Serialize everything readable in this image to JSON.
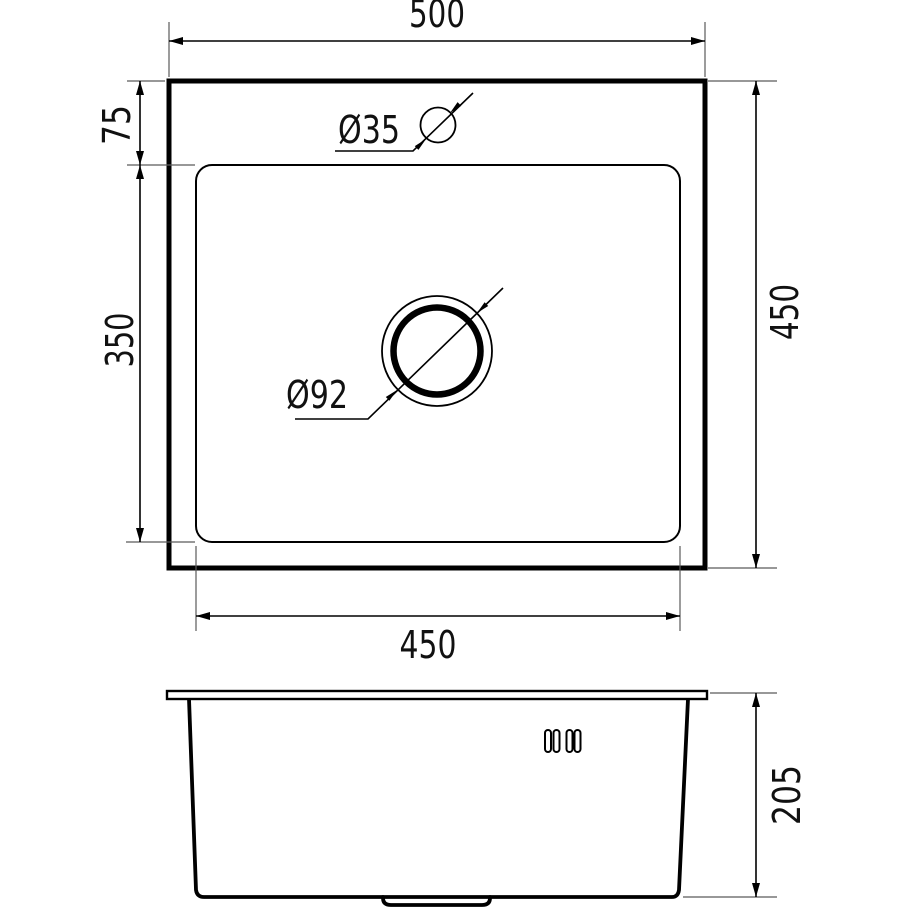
{
  "drawing": {
    "type": "sink-technical-drawing",
    "background_color": "#ffffff",
    "line_color": "#000000",
    "views": {
      "top": {
        "dimensions": {
          "overall_width": "500",
          "faucet_offset": "75",
          "bowl_depth": "350",
          "overall_depth": "450",
          "bowl_width": "450",
          "faucet_hole_diameter": "Ø35",
          "drain_hole_diameter": "Ø92"
        }
      },
      "side": {
        "dimensions": {
          "overall_height": "205"
        }
      }
    }
  }
}
